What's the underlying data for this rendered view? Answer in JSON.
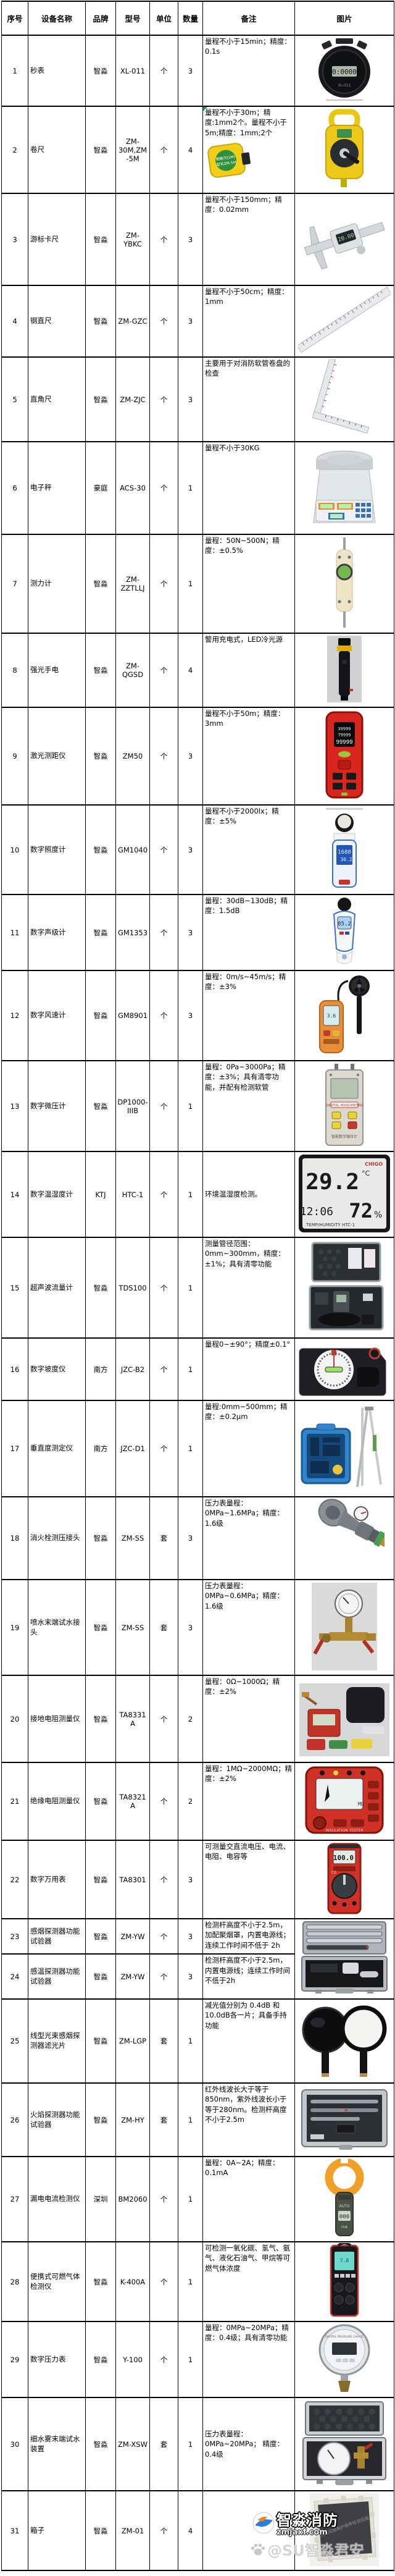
{
  "watermark": {
    "brand": "智淼消防",
    "site": "zmjaxf.com",
    "handle": "@SU智淼君安"
  },
  "colors": {
    "grid": "#000000",
    "comment_marker": "#00a651",
    "brand_red": "#d5342a",
    "brand_yellow": "#f3d11a"
  },
  "photo_text": {
    "stopwatch_display": "0:0000",
    "stopwatch_model": "XL-011",
    "tape_label1": "钢卷尺(5M)",
    "tape_label2": "型号ZM-5M",
    "caliper_display": "20.00",
    "rangefinder_l1": "39999",
    "rangefinder_l2": "79999",
    "rangefinder_l3": "99999",
    "lux_l1": "1680",
    "lux_l2": "30.2",
    "sound_display": "85.2",
    "anemo_display": "3.6",
    "micro_label": "DIGITAL MANOMETER",
    "micro_caption": "智能数字微压计",
    "hygro_brand": "CHIGO",
    "hygro_temp": "29.2",
    "hygro_unit": "°C",
    "hygro_time": "12:06",
    "hygro_humidity": "72",
    "hygro_pct": "%",
    "hygro_caption": "TEMP/HUMIDITY HTC-1",
    "insulation_unit": "MΩ",
    "insulation_caption": "INSULATION TESTER",
    "multimeter_display": "100.0",
    "multimeter_ce": "CE",
    "clamp_auto": "AUTO",
    "clamp_display": "000",
    "clamp_unit": "mA",
    "gas_display": "7.8",
    "gauge_caption": "DIGITAL PRESSURE GAUGE",
    "board_caption": "消防设施维护保养检测设备"
  },
  "table": {
    "columns": [
      {
        "key": "num",
        "label": "序号"
      },
      {
        "key": "name",
        "label": "设备名称"
      },
      {
        "key": "brand",
        "label": "品牌"
      },
      {
        "key": "model",
        "label": "型号"
      },
      {
        "key": "unit",
        "label": "单位"
      },
      {
        "key": "qty",
        "label": "数量"
      },
      {
        "key": "note",
        "label": "备注"
      },
      {
        "key": "photo",
        "label": "图片"
      }
    ],
    "rows": [
      {
        "num": "1",
        "name": "秒表",
        "brand": "智淼",
        "model": "XL-011",
        "unit": "个",
        "qty": "3",
        "note": "量程不小于15min；精度：0.1s",
        "photo": "stopwatch"
      },
      {
        "num": "2",
        "name": "卷尺",
        "brand": "智淼",
        "model": "ZM-30M,ZM-5M",
        "unit": "个",
        "qty": "4",
        "note": "量程不小于30m；精度:1mm2个。量程不小于5m;精度：1mm;2个",
        "photo": "tape-reel",
        "note_photo": "tape-small",
        "note_marker": true
      },
      {
        "num": "3",
        "name": "游标卡尺",
        "brand": "智淼",
        "model": "ZM-YBKC",
        "unit": "个",
        "qty": "3",
        "note": "量程不小于150mm；精度：0.02mm",
        "photo": "caliper"
      },
      {
        "num": "4",
        "name": "钢直尺",
        "brand": "智淼",
        "model": "ZM-GZC",
        "unit": "个",
        "qty": "3",
        "note": "量程不小于50cm；精度：1mm",
        "photo": "ruler"
      },
      {
        "num": "5",
        "name": "直角尺",
        "brand": "智淼",
        "model": "ZM-ZJC",
        "unit": "个",
        "qty": "3",
        "note": "主要用于对消防软管卷盘的检查",
        "photo": "square-ruler"
      },
      {
        "num": "6",
        "name": "电子秤",
        "brand": "豪庭",
        "model": "ACS-30",
        "unit": "个",
        "qty": "1",
        "note": "量程不小于30KG",
        "photo": "scale"
      },
      {
        "num": "7",
        "name": "测力计",
        "brand": "智淼",
        "model": "ZM-ZZTLLJ",
        "unit": "个",
        "qty": "1",
        "note": "量程：50N~500N；精度：±0.5%",
        "photo": "force-gauge"
      },
      {
        "num": "8",
        "name": "强光手电",
        "brand": "智淼",
        "model": "ZM-QGSD",
        "unit": "个",
        "qty": "4",
        "note": "警用充电式，LED冷光源",
        "photo": "flashlight"
      },
      {
        "num": "9",
        "name": "激光测距仪",
        "brand": "智淼",
        "model": "ZM50",
        "unit": "个",
        "qty": "3",
        "note": "量程不小于50m；精度：3mm",
        "photo": "rangefinder"
      },
      {
        "num": "10",
        "name": "数字照度计",
        "brand": "智淼",
        "model": "GM1040",
        "unit": "个",
        "qty": "3",
        "note": "量程不小于2000lx；精度：±5%",
        "photo": "lux-meter"
      },
      {
        "num": "11",
        "name": "数字声级计",
        "brand": "智淼",
        "model": "GM1353",
        "unit": "个",
        "qty": "3",
        "note": "量程：30dB~130dB；精度：1.5dB",
        "photo": "sound-meter"
      },
      {
        "num": "12",
        "name": "数字风速计",
        "brand": "智淼",
        "model": "GM8901",
        "unit": "个",
        "qty": "3",
        "note": "量程：0m/s~45m/s；精度：±3%",
        "photo": "anemometer"
      },
      {
        "num": "13",
        "name": "数字微压计",
        "brand": "智淼",
        "model": "DP1000-IIIB",
        "unit": "个",
        "qty": "1",
        "note": "量程：0Pa~3000Pa；精度：±3%；具有清零功能，并配有检测软管",
        "photo": "micro-pressure"
      },
      {
        "num": "14",
        "name": "数字温湿度计",
        "brand": "KTJ",
        "model": "HTC-1",
        "unit": "个",
        "qty": "1",
        "note": "环境温湿度检测。",
        "photo": "hygrometer",
        "note_align": "middle"
      },
      {
        "num": "15",
        "name": "超声波流量计",
        "brand": "智淼",
        "model": "TDS100",
        "unit": "个",
        "qty": "1",
        "note": "测量管径范围：0mm~300mm，精度：±1%；具有清零功能",
        "photo": "flow-case"
      },
      {
        "num": "16",
        "name": "数字坡度仪",
        "brand": "南方",
        "model": "JZC-B2",
        "unit": "个",
        "qty": "1",
        "note": "量程0~±90°；精度±0.1°",
        "photo": "inclinometer"
      },
      {
        "num": "17",
        "name": "垂直度测定仪",
        "brand": "南方",
        "model": "JZC-D1",
        "unit": "个",
        "qty": "1",
        "note": "量程:0mm~500mm；精度：±0.2μm",
        "photo": "vertical-kit",
        "model_marker": true
      },
      {
        "num": "18",
        "name": "消火栓测压接头",
        "brand": "智淼",
        "model": "ZM-SS",
        "unit": "套",
        "qty": "3",
        "note": "压力表量程：0MPa~1.6MPa；精度：1.6级",
        "photo": "hydrant-nozzle"
      },
      {
        "num": "19",
        "name": "喷水末端试水接头",
        "brand": "智淼",
        "model": "ZM-SS",
        "unit": "套",
        "qty": "3",
        "note": "压力表量程：0MPa~0.6MPa；精度：1.6级",
        "photo": "test-connector"
      },
      {
        "num": "20",
        "name": "接地电阻测量仪",
        "brand": "智淼",
        "model": "TA8331A",
        "unit": "个",
        "qty": "2",
        "note": "量程：0Ω~1000Ω；精度：±2%",
        "photo": "earth-tester"
      },
      {
        "num": "21",
        "name": "绝缘电阻测量仪",
        "brand": "智淼",
        "model": "TA8321A",
        "unit": "个",
        "qty": "2",
        "note": "量程：1MΩ~2000MΩ；精度：±2%",
        "photo": "insulation-tester"
      },
      {
        "num": "22",
        "name": "数字万用表",
        "brand": "智淼",
        "model": "TA8301",
        "unit": "个",
        "qty": "3",
        "note": "可测量交直流电压、电流、电阻、电容等",
        "photo": "multimeter"
      },
      {
        "num": "23",
        "name": "感烟探测器功能试验器",
        "brand": "智淼",
        "model": "ZM-YW",
        "unit": "个",
        "qty": "3",
        "note": "检测杆高度不小于2.5m，加配聚烟罩，内置电源线；连续工作时间不低于 2h",
        "photo": "alu-case",
        "photo_rowspan": 2
      },
      {
        "num": "24",
        "name": "感温探测器功能试验器",
        "brand": "智淼",
        "model": "ZM-YW",
        "unit": "个",
        "qty": "3",
        "note": "检测杆高度不小于2.5m，内置电源线；连续工作时间不低于2h",
        "photo": null,
        "photo_merged": true
      },
      {
        "num": "25",
        "name": "线型光束感烟探测器滤光片",
        "brand": "智淼",
        "model": "ZM-LGP",
        "unit": "套",
        "qty": "1",
        "note": "减光值分别为 0.4dB 和10.0dB各一片；具备手持功能",
        "photo": "filters"
      },
      {
        "num": "26",
        "name": "火焰探测器功能试验器",
        "brand": "智淼",
        "model": "ZM-HY",
        "unit": "套",
        "qty": "1",
        "note": "红外线波长大于等于850nm，紫外线波长小于等于280nm。检测杆高度不小于2.5m",
        "photo": "flame-case"
      },
      {
        "num": "27",
        "name": "漏电电流检测仪",
        "brand": "深圳",
        "model": "BM2060",
        "unit": "个",
        "qty": "1",
        "note": "量程：0A~2A；精度：0.1mA",
        "photo": "clamp-meter"
      },
      {
        "num": "28",
        "name": "便携式可燃气体检测仪",
        "brand": "智淼",
        "model": "K-400A",
        "unit": "个",
        "qty": "1",
        "note": "可检测一氧化碳、氢气、氨气、液化石油气、甲烷等可燃气体浓度",
        "photo": "gas-detector"
      },
      {
        "num": "29",
        "name": "数字压力表",
        "brand": "智淼",
        "model": "Y-100",
        "unit": "个",
        "qty": "1",
        "note": "量程：0MPa~20MPa；精度：0.4级；具有清零功能",
        "photo": "pressure-gauge"
      },
      {
        "num": "30",
        "name": "细水雾末端试水装置",
        "brand": "智淼",
        "model": "ZM-XSW",
        "unit": "套",
        "qty": "1",
        "note": "压力表量程：0MPa~20MPa；\n精度：0.4级",
        "photo": "xsw-case",
        "note_align": "middle"
      },
      {
        "num": "31",
        "name": "箱子",
        "brand": "智淼",
        "model": "ZM-01",
        "unit": "个",
        "qty": "4",
        "note": "",
        "photo": "board-box"
      }
    ]
  }
}
